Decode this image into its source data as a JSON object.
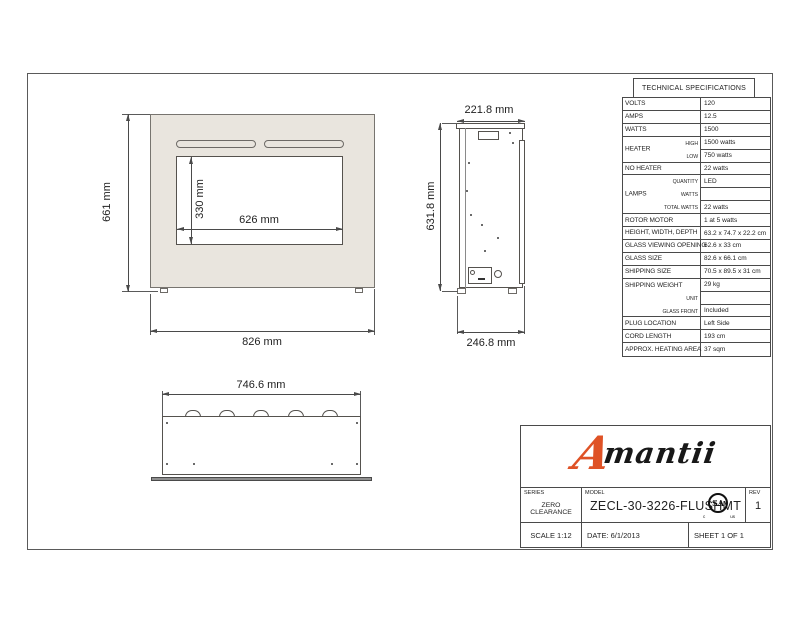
{
  "front_view": {
    "height": "661 mm",
    "window_height": "330 mm",
    "window_width": "626 mm",
    "width": "826 mm"
  },
  "side_view": {
    "top_width": "221.8 mm",
    "height": "631.8 mm",
    "bottom_width": "246.8 mm"
  },
  "bottom_view": {
    "width": "746.6 mm"
  },
  "spec_table": {
    "title": "TECHNICAL SPECIFICATIONS",
    "labels": {
      "volts": "VOLTS",
      "amps": "AMPS",
      "watts": "WATTS",
      "heater": "HEATER",
      "high": "HIGH",
      "low": "LOW",
      "no_heater": "NO HEATER",
      "lamps": "LAMPS",
      "quantity": "QUANTITY",
      "lamps_watts": "WATTS",
      "total_watts": "TOTAL WATTS",
      "rotor_motor": "ROTOR MOTOR",
      "hwd": "HEIGHT, WIDTH, DEPTH",
      "gvo": "GLASS VIEWING OPENING",
      "glass_size": "GLASS SIZE",
      "shipping_size": "SHIPPING SIZE",
      "shipping_weight": "SHIPPING WEIGHT",
      "unit": "UNIT",
      "glass_front": "GLASS FRONT",
      "plug_location": "PLUG LOCATION",
      "cord_length": "CORD LENGTH",
      "heating_area": "APPROX. HEATING AREA"
    },
    "values": {
      "volts": "120",
      "amps": "12.5",
      "watts": "1500",
      "heater_high": "1500 watts",
      "heater_low": "750 watts",
      "no_heater": "22 watts",
      "lamps_quantity": "LED",
      "lamps_watts": "",
      "lamps_total_watts": "22 watts",
      "rotor_motor": "1 at 5 watts",
      "hwd": "63.2 x 74.7 x 22.2 cm",
      "gvo": "62.6 x 33 cm",
      "glass_size": "82.6 x 66.1 cm",
      "shipping_size": "70.5 x 89.5 x 31 cm",
      "shipping_weight": "29 kg",
      "unit": "",
      "glass_front": "Included",
      "plug_location": "Left Side",
      "cord_length": "193 cm",
      "heating_area": "37 sqm"
    }
  },
  "title_block": {
    "logo_initial": "A",
    "logo_rest": "mantii",
    "series_label": "SERIES",
    "series_value": "ZERO CLEARANCE",
    "model_label": "MODEL",
    "model_value": "ZECL-30-3226-FLUSHMT",
    "rev_label": "REV",
    "rev_value": "1",
    "scale": "SCALE 1:12",
    "date": "DATE: 6/1/2013",
    "sheet": "SHEET 1 OF 1",
    "csa_mark": "SA",
    "csa_c": "c",
    "csa_us": "us"
  },
  "colors": {
    "accent_orange": "#df5226",
    "panel_beige": "#e9e5de",
    "line_gray": "#4a4a4a"
  }
}
